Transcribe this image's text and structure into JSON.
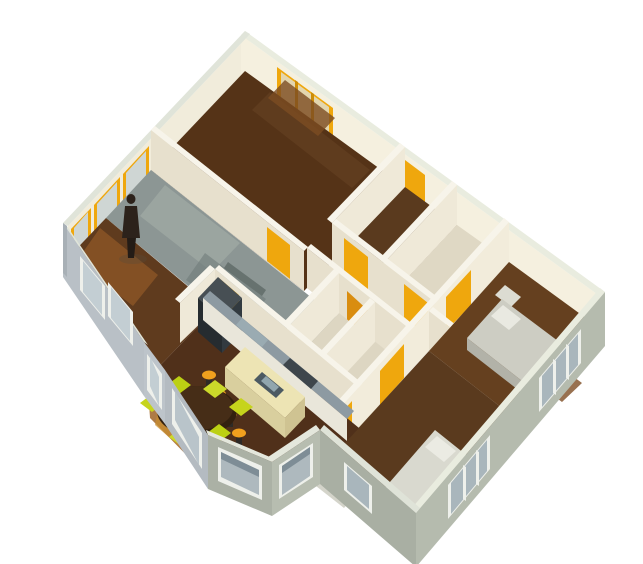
{
  "view": {
    "kind": "3d-axonometric-floorplan-render",
    "width": 643,
    "height": 564,
    "background": "#ffffff"
  },
  "palette": {
    "interior_wall": "#e7e0cd",
    "interior_wall_lit": "#f2ecdb",
    "wall_top": "#f7f4ea",
    "exterior_wall_blue": "#b9c0c6",
    "exterior_wall_green": "#b0b6a9",
    "window_frame_white": "#eef0eb",
    "window_frame_amber": "#efa70d",
    "door_amber": "#efa70d",
    "door_orange": "#d98d10",
    "floor_wood_dark": "#50301a",
    "floor_wood_mid": "#5f3b1e",
    "floor_wood_lit": "#a06426",
    "floor_gray": "#8c9694",
    "floor_cream": "#ddd6c2",
    "island_cream": "#ede4b4",
    "counter_bluegray": "#8d9aa2",
    "appliance_dark": "#3e464c",
    "chair_chartreuse": "#c6d41c",
    "stool_amber": "#f0a01e",
    "table_wood": "#33200f",
    "bed_gray": "#cdcdc3",
    "bed_white": "#d9d9cf",
    "person_dark": "#2c221b"
  },
  "shapes": [
    {
      "n": "nw-wall-inner-face",
      "t": "p",
      "f": "#f1ecdb",
      "p": "250,34 68,226 68,266 250,74"
    },
    {
      "n": "nw-window-1-frame",
      "t": "p",
      "f": "#efa70d",
      "p": "149,146 123,174 123,206 149,178"
    },
    {
      "n": "nw-window-1-glass",
      "t": "p",
      "f": "#cfd6d4",
      "p": "146,151 126,173 126,201 146,179"
    },
    {
      "n": "nw-window-2-frame",
      "t": "p",
      "f": "#efa70d",
      "p": "120,177 94,205 94,237 120,209"
    },
    {
      "n": "nw-window-2-glass",
      "t": "p",
      "f": "#cfd6d4",
      "p": "117,182 97,204 97,232 117,210"
    },
    {
      "n": "nw-window-3-frame",
      "t": "p",
      "f": "#efa70d",
      "p": "91,208 71,229 71,261 91,240"
    },
    {
      "n": "nw-window-3-glass",
      "t": "p",
      "f": "#cfd6d4",
      "p": "88,212 74,228 74,256 88,241"
    },
    {
      "n": "ne-wall-inner-face",
      "t": "p",
      "f": "#f5f0df",
      "p": "241,35 601,297 601,337 241,75"
    },
    {
      "n": "bedroom1-window-frame",
      "t": "p",
      "f": "#efa70d",
      "p": "277,67 333,108 333,140 277,106"
    },
    {
      "n": "bedroom1-window-glass",
      "t": "p",
      "f": "#e3d6ae",
      "p": "281,72 329,107 329,134 281,99"
    },
    {
      "n": "bedroom1-window-mullion-1",
      "t": "p",
      "f": "#cd8d08",
      "p": "295,80 298,82 298,115 295,113"
    },
    {
      "n": "bedroom1-window-mullion-2",
      "t": "p",
      "f": "#cd8d08",
      "p": "311,92 314,94 314,126 311,124"
    },
    {
      "n": "hall-north-door",
      "t": "p",
      "f": "#efa70d",
      "p": "405,160 425,175 425,207 405,192"
    },
    {
      "n": "ne-wall-top",
      "t": "p",
      "f": "#e9ecdf",
      "p": "245,31 605,292 601,297 241,35"
    },
    {
      "n": "nw-wall-top",
      "t": "p",
      "f": "#e0e4d9",
      "p": "245,31 63,223 68,226 250,34"
    },
    {
      "n": "bedroom1-floor",
      "t": "p",
      "f": "#553317",
      "p": "245,71 405,187 304,291 151,170"
    },
    {
      "n": "bedroom1-floor-streak",
      "t": "p",
      "f": "#644022",
      "o": 0.7,
      "p": "270,92 370,170 352,188 252,110"
    },
    {
      "n": "bedroom1-floor-lit",
      "t": "p",
      "f": "#7c4c22",
      "o": 0.8,
      "p": "285,80 335,118 318,136 268,98"
    },
    {
      "n": "bedroom2-floor",
      "t": "p",
      "f": "#5a3a1e",
      "p": "405,187 457,225 384,303 332,263"
    },
    {
      "n": "bath1-floor",
      "t": "p",
      "f": "#dfd8c4",
      "p": "457,225 509,262 436,343 384,303"
    },
    {
      "n": "bath1-counter",
      "t": "p",
      "f": "#ccd7d9",
      "p": "425,295 450,313 438,327 413,309"
    },
    {
      "n": "wall-bedroom1-east-face",
      "t": "p",
      "f": "#efe9d8",
      "p": "405,147 332,223 332,263 405,187"
    },
    {
      "n": "wall-bedroom1-east-top",
      "t": "p",
      "f": "#f7f4ea",
      "p": "405,147 332,223 327,219 400,143"
    },
    {
      "n": "wall-bedroom2-east-face",
      "t": "p",
      "f": "#efe9d8",
      "p": "457,185 384,263 384,303 457,225"
    },
    {
      "n": "wall-bedroom2-east-top",
      "t": "p",
      "f": "#f7f4ea",
      "p": "457,185 384,263 379,259 452,181"
    },
    {
      "n": "wall-bedroom1-south-face",
      "t": "p",
      "f": "#e7e0cd",
      "p": "151,130 304,251 304,291 151,170"
    },
    {
      "n": "wall-bedroom1-south-top",
      "t": "p",
      "f": "#f7f4ea",
      "p": "151,130 304,251 308,247 155,126"
    },
    {
      "n": "bedroom1-door",
      "t": "p",
      "f": "#efa70d",
      "p": "267,227 290,245 290,279 267,261"
    },
    {
      "n": "wall-hall-north-face",
      "t": "p",
      "f": "#e7e0cd",
      "p": "332,223 436,303 436,343 332,263"
    },
    {
      "n": "wall-hall-north-top",
      "t": "p",
      "f": "#f7f4ea",
      "p": "332,223 436,303 440,299 336,219"
    },
    {
      "n": "bedroom2-door",
      "t": "p",
      "f": "#efa70d",
      "p": "344,238 368,257 368,291 344,272"
    },
    {
      "n": "bath1-door",
      "t": "p",
      "f": "#efa70d",
      "p": "404,284 428,303 428,337 404,317"
    },
    {
      "n": "hall-floor",
      "t": "p",
      "f": "#ddd6c2",
      "p": "332,263 436,343 411,370 307,288"
    },
    {
      "n": "grayroom-floor",
      "t": "p",
      "f": "#8c9694",
      "p": "151,170 336,317 287,368 106,218"
    },
    {
      "n": "grayroom-floor-light",
      "t": "p",
      "f": "#9ca6a1",
      "o": 0.9,
      "p": "165,185 240,243 212,272 140,216"
    },
    {
      "n": "grayroom-floor-shadow",
      "t": "p",
      "f": "#6f7b79",
      "o": 0.6,
      "p": "205,253 266,299 246,324 186,280"
    },
    {
      "n": "grayroom-desk-shadow",
      "t": "p",
      "f": "#57625f",
      "o": 0.7,
      "p": "228,262 266,290 262,296 224,268"
    },
    {
      "n": "wall-hall-south-face",
      "t": "p",
      "f": "#e7e0cd",
      "p": "307,248 411,330 411,370 307,288"
    },
    {
      "n": "wall-hall-south-top",
      "t": "p",
      "f": "#f7f4ea",
      "p": "307,248 411,330 415,326 311,244"
    },
    {
      "n": "bath2-orange-door",
      "t": "p",
      "f": "#d98d10",
      "p": "347,291 371,313 371,347 347,331"
    },
    {
      "n": "wall-bath-west-face",
      "t": "p",
      "f": "#efe9d8",
      "p": "339,273 287,328 287,368 339,313"
    },
    {
      "n": "wall-bath-west-top",
      "t": "p",
      "f": "#f7f4ea",
      "p": "339,273 287,328 282,324 334,269"
    },
    {
      "n": "bath2-floor",
      "t": "p",
      "f": "#ddd6c2",
      "p": "339,313 411,370 359,428 287,368"
    },
    {
      "n": "wall-bath-mid-face",
      "t": "p",
      "f": "#efe9d8",
      "p": "375,302 323,358 323,398 375,342"
    },
    {
      "n": "wall-bath-mid-top",
      "t": "p",
      "f": "#f7f4ea",
      "p": "375,302 323,358 318,354 370,298"
    },
    {
      "n": "wall-kitchen-north-face",
      "t": "p",
      "f": "#e7e0cd",
      "p": "215,269 359,388 359,428 215,309"
    },
    {
      "n": "wall-kitchen-north-top",
      "t": "p",
      "f": "#f7f4ea",
      "p": "215,269 359,388 363,384 219,265"
    },
    {
      "n": "kitchen-door",
      "t": "p",
      "f": "#efa70d",
      "p": "219,278 239,295 239,329 219,312"
    },
    {
      "n": "wall-center-east-face",
      "t": "p",
      "f": "#f2ecdb",
      "p": "509,222 320,430 320,470 509,262"
    },
    {
      "n": "wall-center-east-top",
      "t": "p",
      "f": "#f7f4ea",
      "p": "509,222 320,430 315,426 504,218"
    },
    {
      "n": "bedroom3-door",
      "t": "p",
      "f": "#efa70d",
      "p": "471,270 446,297 446,331 471,305"
    },
    {
      "n": "bedroom4-door",
      "t": "p",
      "f": "#efa70d",
      "p": "404,344 380,371 380,405 404,378"
    },
    {
      "n": "bay-hall-door",
      "t": "p",
      "f": "#efa70d",
      "p": "352,401 331,424 331,458 352,432"
    },
    {
      "n": "wall-bedroom3-south-face",
      "t": "p",
      "f": "#e7e0cd",
      "p": "429,311 525,386 525,426 429,351"
    },
    {
      "n": "wall-bedroom3-south-top",
      "t": "p",
      "f": "#f7f4ea",
      "p": "429,311 525,386 529,382 433,307"
    },
    {
      "n": "bedroom3-floor",
      "t": "p",
      "f": "#65401f",
      "p": "509,262 605,332 525,426 429,351"
    },
    {
      "n": "bedroom3-floor-lit",
      "t": "p",
      "f": "#7e4e24",
      "o": 0.8,
      "p": "540,352 582,383 562,402 520,371"
    },
    {
      "n": "bedroom3-nightstand",
      "t": "p",
      "f": "#dcdcd2",
      "p": "505,285 521,297 511,307 495,295"
    },
    {
      "n": "bedroom3-bed-top",
      "t": "p",
      "f": "#cdcdc3",
      "p": "502,299 566,347 531,388 467,338"
    },
    {
      "n": "bedroom3-bed-side",
      "t": "p",
      "f": "#b2b2a8",
      "p": "467,338 531,388 531,400 467,350"
    },
    {
      "n": "bedroom3-bed-pillow",
      "t": "p",
      "f": "#e9e9e1",
      "p": "503,305 521,319 509,330 491,316"
    },
    {
      "n": "bedroom4-floor",
      "t": "p",
      "f": "#5a3a1e",
      "p": "429,351 525,426 416,553 320,470"
    },
    {
      "n": "bedroom4-dresser",
      "t": "p",
      "f": "#d4d4ca",
      "p": "330,470 358,492 344,508 316,486"
    },
    {
      "n": "bedroom4-bed-top",
      "t": "p",
      "f": "#d9d9cf",
      "p": "435,430 475,462 423,524 383,490"
    },
    {
      "n": "bedroom4-bed-side",
      "t": "p",
      "f": "#bdbdb3",
      "p": "383,490 423,524 423,536 383,502"
    },
    {
      "n": "bedroom4-bed-pillow",
      "t": "p",
      "f": "#ebebe3",
      "p": "437,436 456,451 444,462 425,447"
    },
    {
      "n": "livingroom-floor",
      "t": "p",
      "f": "#5f3b1e",
      "p": "106,218 215,309 144,382 63,263"
    },
    {
      "n": "livingroom-floor-lit",
      "t": "p",
      "f": "#8a5526",
      "o": 0.85,
      "p": "100,228 158,275 133,306 76,262"
    },
    {
      "n": "person-shadow",
      "t": "e",
      "f": "#594a3a",
      "o": 0.35,
      "cx": 133,
      "cy": 259,
      "rx": 14,
      "ry": 5
    },
    {
      "n": "person-torso",
      "t": "p",
      "f": "#2c221b",
      "p": "125,206 137,206 140,238 122,238"
    },
    {
      "n": "person-legs",
      "t": "p",
      "f": "#241c16",
      "p": "127,238 136,238 134,258 128,258"
    },
    {
      "n": "person-head",
      "t": "e",
      "f": "#2c221b",
      "cx": 131,
      "cy": 199,
      "rx": 4.5,
      "ry": 5
    },
    {
      "n": "kitchen-dining-floor",
      "t": "p",
      "f": "#50301a",
      "p": "215,309 359,428 320,470 270,506 214,460 165,410 144,382"
    },
    {
      "n": "kitchen-floor-lit",
      "t": "p",
      "f": "#a06426",
      "o": 0.85,
      "p": "148,388 235,450 208,477 150,418"
    },
    {
      "n": "kitchen-floor-lit2",
      "t": "p",
      "f": "#c98e2e",
      "o": 0.7,
      "p": "160,400 215,440 195,460 155,425"
    },
    {
      "n": "wall-kitchen-west-face",
      "t": "p",
      "f": "#efe9d8",
      "p": "215,269 180,303 180,343 215,309"
    },
    {
      "n": "wall-kitchen-west-top",
      "t": "p",
      "f": "#f7f4ea",
      "p": "215,269 180,303 175,299 210,265"
    },
    {
      "n": "fridge-top",
      "t": "p",
      "f": "#474f54",
      "p": "218,277 242,298 222,319 198,298"
    },
    {
      "n": "fridge-east-face",
      "t": "p",
      "f": "#323a40",
      "p": "242,298 222,319 222,353 242,332"
    },
    {
      "n": "fridge-south-face",
      "t": "p",
      "f": "#262c30",
      "p": "198,298 222,319 222,353 198,332"
    },
    {
      "n": "kitchen-counter-top",
      "t": "p",
      "f": "#8d9aa2",
      "p": "210,291 354,411 347,419 203,298"
    },
    {
      "n": "kitchen-counter-face",
      "t": "p",
      "f": "#e9e6da",
      "p": "203,298 347,419 347,441 203,320"
    },
    {
      "n": "counter-sink-steel",
      "t": "p",
      "f": "#9aabb2",
      "p": "242,318 268,340 262,347 236,325"
    },
    {
      "n": "counter-stove",
      "t": "p",
      "f": "#3e464c",
      "p": "290,358 318,381 311,389 283,365"
    },
    {
      "n": "island-top",
      "t": "p",
      "f": "#ede4b4",
      "p": "245,347 305,397 285,418 225,367"
    },
    {
      "n": "island-south-face",
      "t": "p",
      "f": "#d9cf9e",
      "p": "225,367 285,418 285,438 225,387"
    },
    {
      "n": "island-east-face",
      "t": "p",
      "f": "#cfc392",
      "p": "305,397 285,418 285,438 305,417"
    },
    {
      "n": "island-sink-dark",
      "t": "p",
      "f": "#4c5a62",
      "p": "262,372 284,390 276,398 254,380"
    },
    {
      "n": "island-sink-steel",
      "t": "p",
      "f": "#91a6ae",
      "p": "266,376 279,387 274,392 261,381"
    },
    {
      "n": "stool-1-base",
      "t": "p",
      "f": "#2e2a26",
      "p": "206,376 212,376 212,388 206,388"
    },
    {
      "n": "stool-1-seat",
      "t": "e",
      "f": "#f0a01e",
      "cx": 209,
      "cy": 375,
      "rx": 7,
      "ry": 4.5
    },
    {
      "n": "stool-2-base",
      "t": "p",
      "f": "#2e2a26",
      "p": "216,395 222,395 222,407 216,407"
    },
    {
      "n": "stool-2-seat",
      "t": "e",
      "f": "#f0a01e",
      "cx": 219,
      "cy": 394,
      "rx": 7,
      "ry": 4.5
    },
    {
      "n": "stool-3-base",
      "t": "p",
      "f": "#2e2a26",
      "p": "227,415 233,415 233,427 227,427"
    },
    {
      "n": "stool-3-seat",
      "t": "e",
      "f": "#f0a01e",
      "cx": 230,
      "cy": 414,
      "rx": 7,
      "ry": 4.5
    },
    {
      "n": "stool-4-base",
      "t": "p",
      "f": "#2e2a26",
      "p": "236,434 242,434 242,446 236,446"
    },
    {
      "n": "stool-4-seat",
      "t": "e",
      "f": "#f0a01e",
      "cx": 239,
      "cy": 433,
      "rx": 7,
      "ry": 4.5
    },
    {
      "n": "dining-table",
      "t": "e",
      "f": "#33200f",
      "cx": 197,
      "cy": 411,
      "rx": 40,
      "ry": 25
    },
    {
      "n": "dining-table-top",
      "t": "e",
      "f": "#462d17",
      "cx": 197,
      "cy": 408,
      "rx": 36,
      "ry": 22
    },
    {
      "n": "chair-1",
      "t": "p",
      "f": "#c6d41c",
      "p": "152,394 164,403 152,412 140,403"
    },
    {
      "n": "chair-2",
      "t": "p",
      "f": "#bcd013",
      "p": "179,376 191,385 179,394 167,385"
    },
    {
      "n": "chair-3",
      "t": "p",
      "f": "#cbd92a",
      "p": "215,380 227,389 215,398 203,389"
    },
    {
      "n": "chair-4",
      "t": "p",
      "f": "#c6d41c",
      "p": "241,398 253,407 241,416 229,407"
    },
    {
      "n": "chair-5",
      "t": "p",
      "f": "#bcd013",
      "p": "219,424 231,433 219,442 207,433"
    },
    {
      "n": "chair-6",
      "t": "p",
      "f": "#cbd92a",
      "p": "181,428 193,437 181,446 169,437"
    },
    {
      "n": "se-wall-top",
      "t": "p",
      "f": "#e9ecdf",
      "p": "605,292 416,513 411,509 600,288"
    },
    {
      "n": "se-exterior-wall",
      "t": "p",
      "f": "#b5bbae",
      "p": "605,292 416,513 416,567 605,346"
    },
    {
      "n": "se-window-1-frame",
      "t": "p",
      "f": "#eef0eb",
      "p": "581,329 539,378 539,412 581,363"
    },
    {
      "n": "se-window-1-glass",
      "t": "p",
      "f": "#a9b6bc",
      "p": "578,334 542,376 542,407 578,365"
    },
    {
      "n": "se-window-1-mullion-1",
      "t": "p",
      "f": "#eef0eb",
      "p": "566,344 569,346 569,380 566,378"
    },
    {
      "n": "se-window-1-mullion-2",
      "t": "p",
      "f": "#eef0eb",
      "p": "553,359 556,361 556,395 553,393"
    },
    {
      "n": "se-window-2-frame",
      "t": "p",
      "f": "#eef0eb",
      "p": "490,435 448,485 448,519 490,469"
    },
    {
      "n": "se-window-2-glass",
      "t": "p",
      "f": "#a9b6bc",
      "p": "487,440 451,483 451,514 487,471"
    },
    {
      "n": "se-window-2-mullion-1",
      "t": "p",
      "f": "#eef0eb",
      "p": "476,450 479,452 479,486 476,484"
    },
    {
      "n": "se-window-2-mullion-2",
      "t": "p",
      "f": "#eef0eb",
      "p": "463,465 466,467 466,501 463,499"
    },
    {
      "n": "south-wing-wall-top",
      "t": "p",
      "f": "#dfe3d8",
      "p": "320,430 416,513 420,508 324,425"
    },
    {
      "n": "south-wing-exterior-wall",
      "t": "p",
      "f": "#a9afa3",
      "p": "320,430 416,513 416,567 320,484"
    },
    {
      "n": "south-wing-window-frame",
      "t": "p",
      "f": "#eef0eb",
      "p": "344,462 372,486 372,514 344,490"
    },
    {
      "n": "south-wing-window-glass",
      "t": "p",
      "f": "#a9b6bc",
      "p": "347,466 369,485 369,509 347,490"
    },
    {
      "n": "bay-face1-top",
      "t": "p",
      "f": "#e4e7dc",
      "p": "320,430 272,462 268,457 316,425"
    },
    {
      "n": "bay-face1-wall",
      "t": "p",
      "f": "#b7bdb0",
      "p": "320,430 272,462 272,516 320,484"
    },
    {
      "n": "bay-window-1-frame",
      "t": "p",
      "f": "#eef0eb",
      "p": "313,443 279,465 279,499 313,477"
    },
    {
      "n": "bay-window-1-glass",
      "t": "p",
      "f": "#aeb9be",
      "p": "310,447 282,466 282,495 310,476"
    },
    {
      "n": "bay-window-1-shade",
      "t": "p",
      "f": "#7e8d96",
      "p": "310,447 282,466 282,473 310,454"
    },
    {
      "n": "bay-face2-top",
      "t": "p",
      "f": "#e4e7dc",
      "p": "272,462 208,435 206,430 270,457"
    },
    {
      "n": "bay-face2-wall",
      "t": "p",
      "f": "#abb1a5",
      "p": "272,462 208,435 208,489 272,516"
    },
    {
      "n": "bay-window-2-frame",
      "t": "p",
      "f": "#eef0eb",
      "p": "262,466 218,447 218,481 262,500"
    },
    {
      "n": "bay-window-2-glass",
      "t": "p",
      "f": "#aeb9be",
      "p": "259,470 221,452 221,477 259,495"
    },
    {
      "n": "bay-window-2-shade",
      "t": "p",
      "f": "#7e8d96",
      "p": "259,470 221,452 221,459 259,477"
    },
    {
      "n": "bay-face3-wall",
      "t": "p",
      "f": "#b4bbc1",
      "p": "208,435 165,370 165,424 208,489"
    },
    {
      "n": "bay-window-3-frame",
      "t": "p",
      "f": "#eef0eb",
      "p": "202,433 172,388 172,424 202,469"
    },
    {
      "n": "bay-window-3-glass",
      "t": "p",
      "f": "#b9c4ca",
      "p": "199,437 175,391 175,420 199,465"
    },
    {
      "n": "bay-face4-wall",
      "t": "p",
      "f": "#bdc4ca",
      "p": "165,370 144,342 144,396 165,424"
    },
    {
      "n": "bay-window-4-frame",
      "t": "p",
      "f": "#eef0eb",
      "p": "162,374 147,354 147,390 162,410"
    },
    {
      "n": "bay-window-4-glass",
      "t": "p",
      "f": "#c3ced3",
      "p": "159,377 150,356 150,386 159,406"
    },
    {
      "n": "sw-wall-top",
      "t": "p",
      "f": "#e0e4d9",
      "p": "144,342 63,223 67,226 148,345"
    },
    {
      "n": "sw-exterior-wall",
      "t": "p",
      "f": "#b9c0c6",
      "p": "144,342 63,223 63,277 144,396"
    },
    {
      "n": "sw-window-1-frame",
      "t": "p",
      "f": "#eef0eb",
      "p": "80,256 105,286 105,320 80,290"
    },
    {
      "n": "sw-window-1-glass",
      "t": "p",
      "f": "#c3ced3",
      "p": "83,261 102,284 102,315 83,292"
    },
    {
      "n": "sw-window-2-frame",
      "t": "p",
      "f": "#eef0eb",
      "p": "108,282 133,312 133,346 108,316"
    },
    {
      "n": "sw-window-2-glass",
      "t": "p",
      "f": "#c3ced3",
      "p": "111,287 130,310 130,341 111,318"
    },
    {
      "n": "west-corner-edge",
      "t": "p",
      "f": "#a8b0b6",
      "p": "63,223 67,226 67,277 63,273"
    }
  ]
}
